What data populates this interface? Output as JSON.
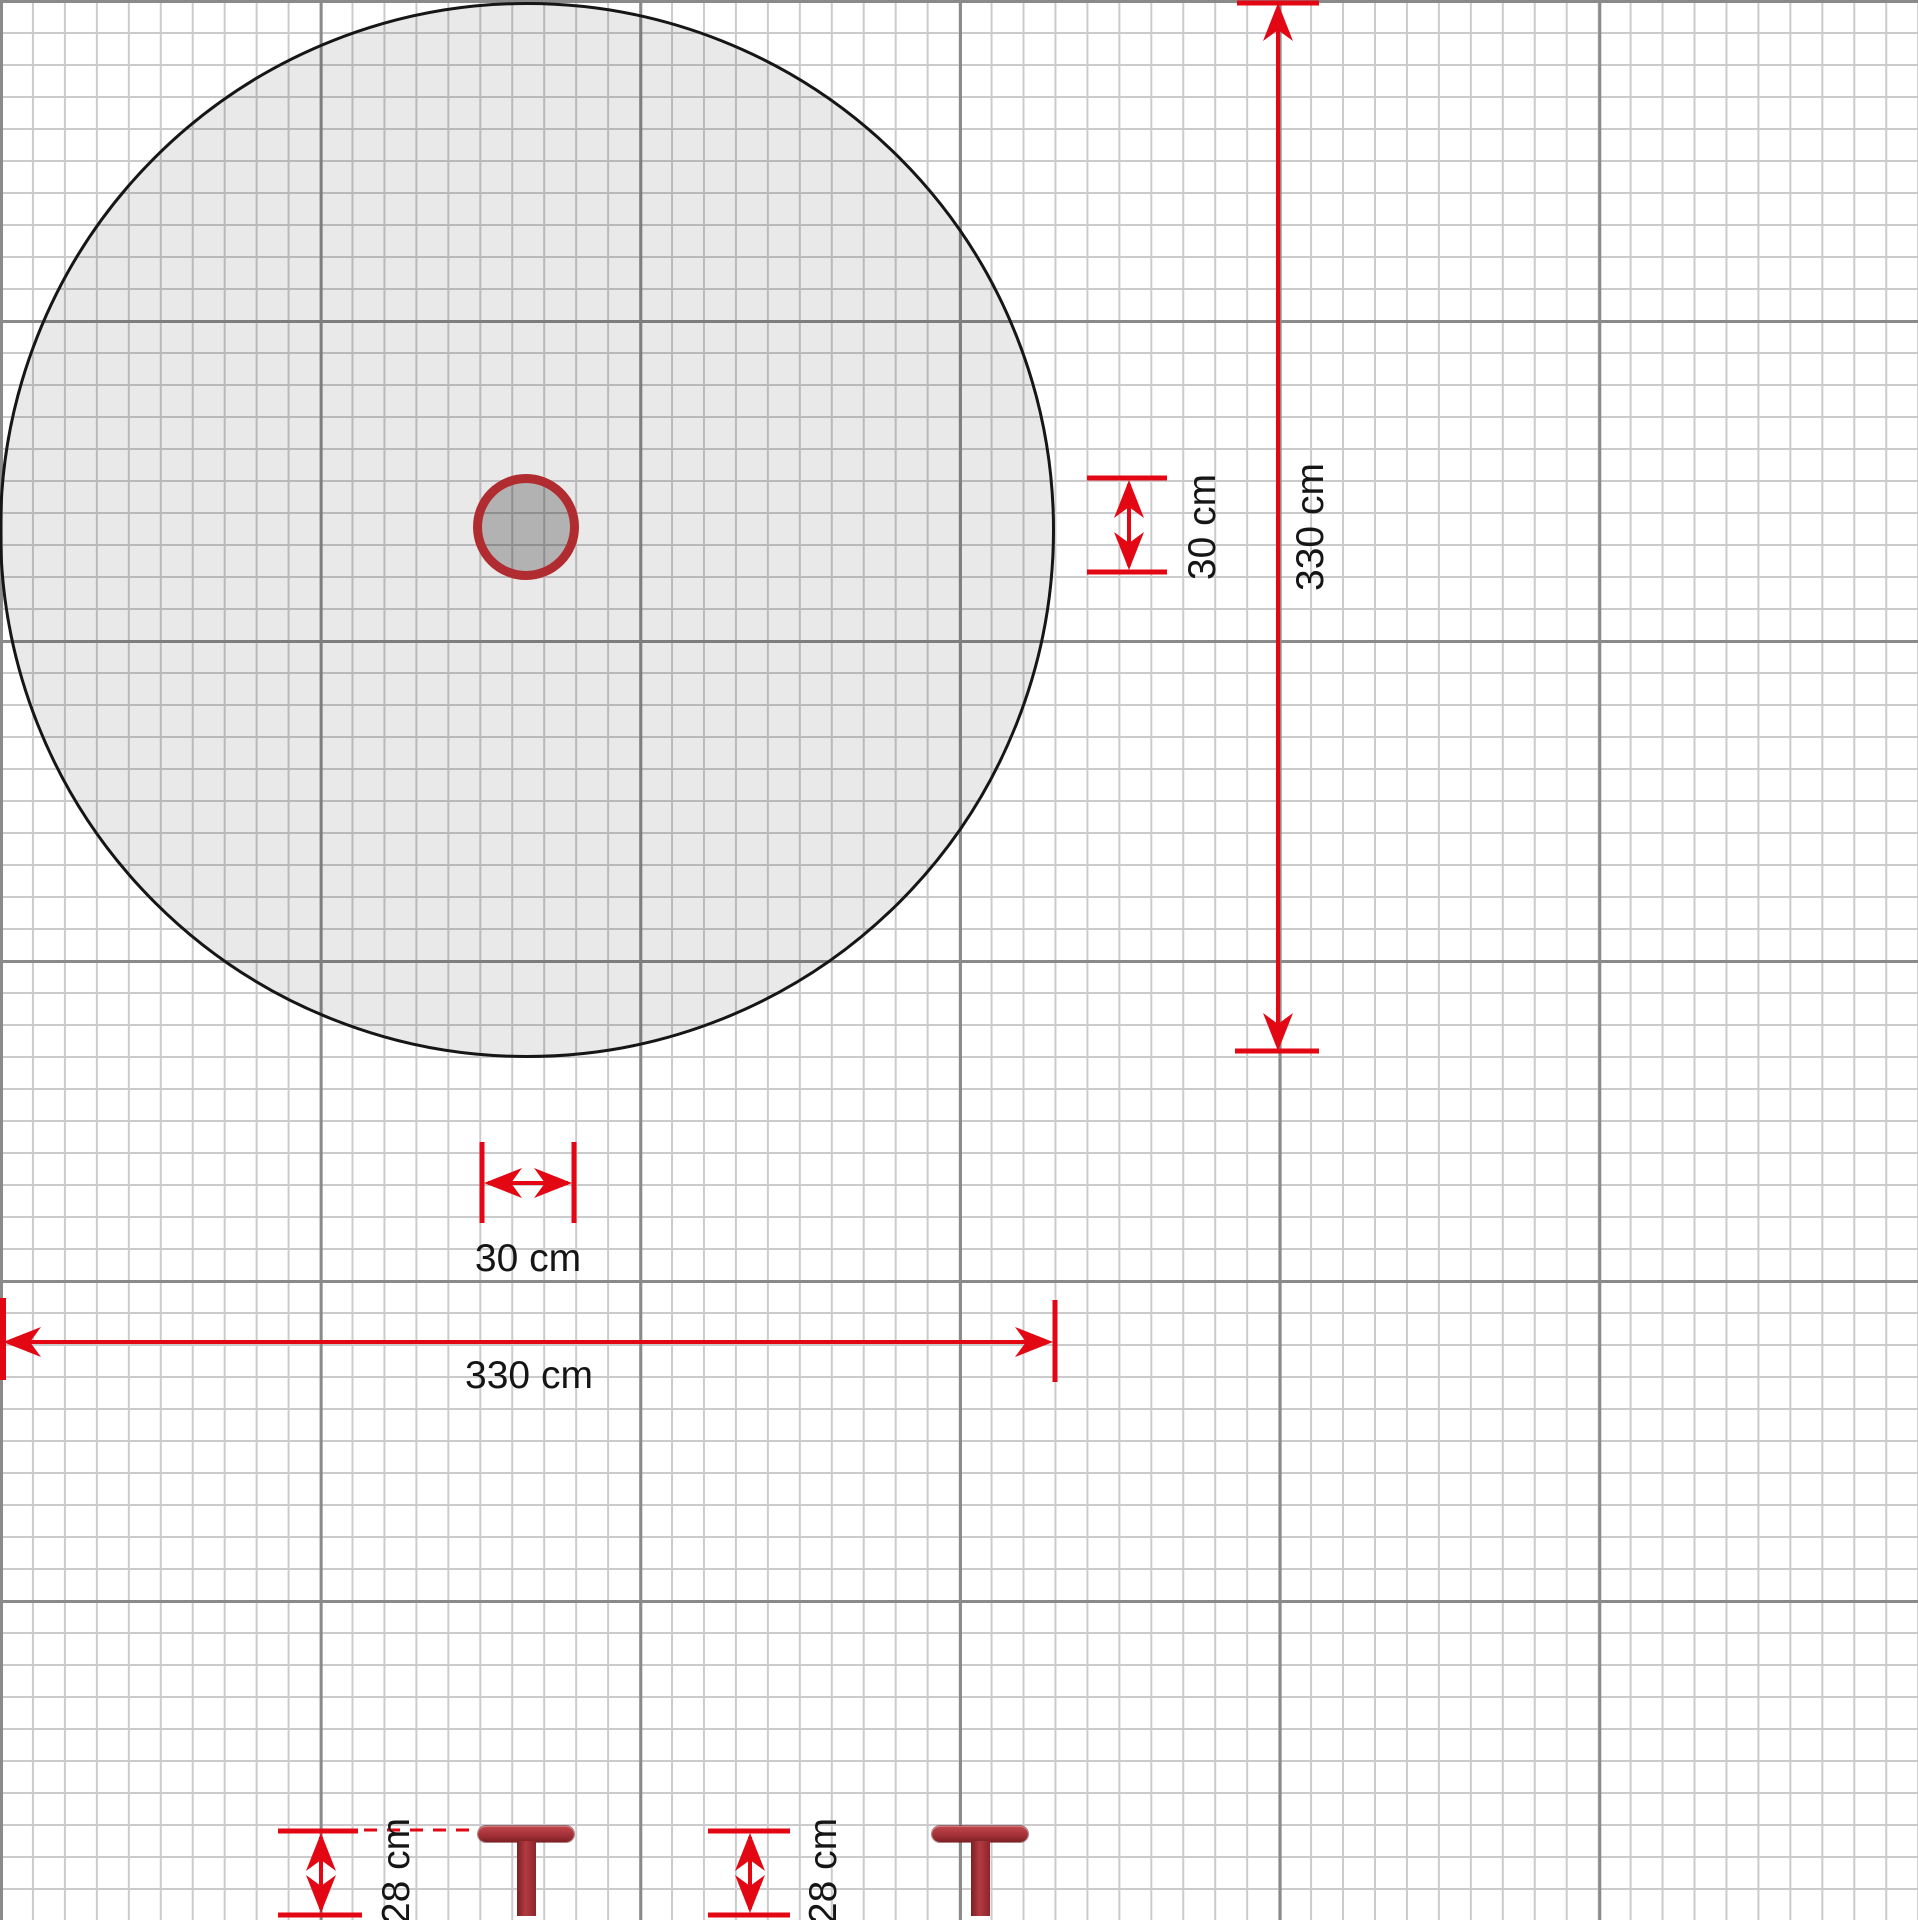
{
  "dimensions": {
    "vertical_total": "330 cm",
    "vertical_post": "30 cm",
    "horizontal_total": "330 cm",
    "horizontal_post": "30 cm",
    "anchor_depth_left": "28 cm",
    "anchor_depth_right": "28 cm"
  },
  "colors": {
    "dimension-red": "#e30613",
    "grid-minor": "#cbcbcd",
    "grid-major": "#8a8a8a",
    "circle-outline": "#161616",
    "post-ring": "#b02c31",
    "anchor-red": "#a03036",
    "label-text": "#151515"
  }
}
